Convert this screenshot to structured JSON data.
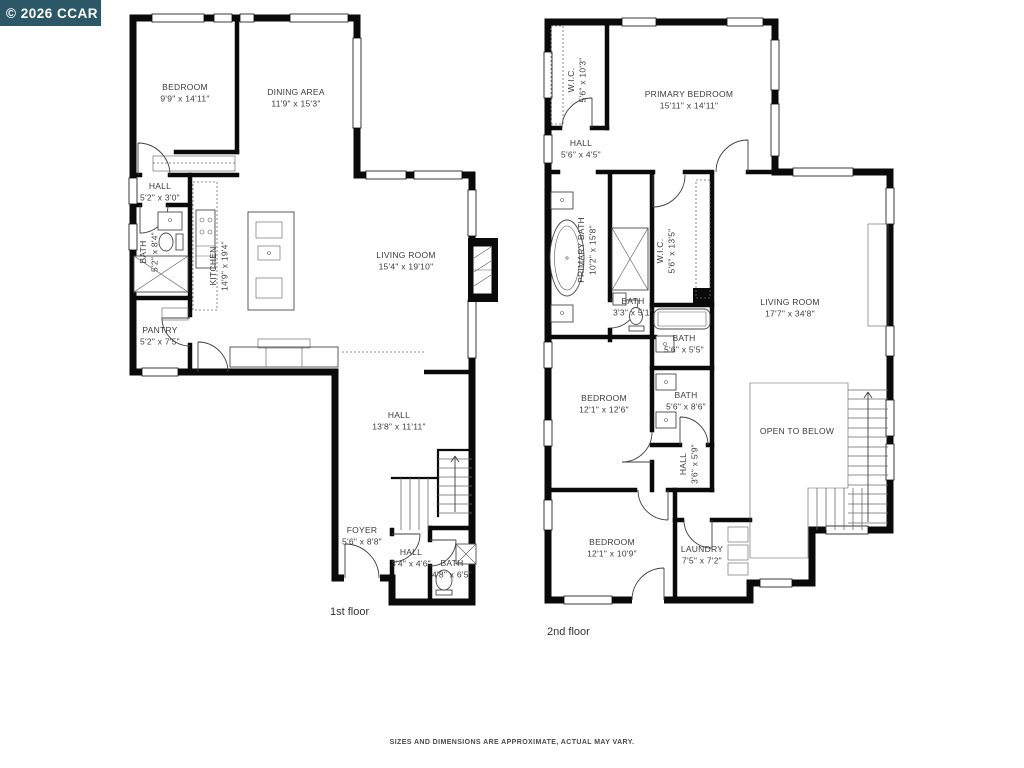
{
  "watermark": {
    "text": "© 2026 CCAR",
    "bg": "#2b5767",
    "fg": "#ffffff"
  },
  "disclaimer": {
    "text": "SIZES AND DIMENSIONS ARE APPROXIMATE, ACTUAL MAY VARY."
  },
  "colors": {
    "wall": "#0a0a0a",
    "label": "#3c3c3c",
    "background": "#ffffff"
  },
  "floors": [
    {
      "id": "floor1",
      "caption": "1st floor",
      "rooms": [
        {
          "name": "BEDROOM",
          "dims": "9'9\" x 14'11\"",
          "x": 185,
          "y": 90,
          "rotate": 0
        },
        {
          "name": "DINING AREA",
          "dims": "11'9\" x 15'3\"",
          "x": 296,
          "y": 95,
          "rotate": 0
        },
        {
          "name": "HALL",
          "dims": "5'2\" x 3'0\"",
          "x": 160,
          "y": 189,
          "rotate": 0
        },
        {
          "name": "BATH",
          "dims": "5'2\" x 8'4\"",
          "x": 146,
          "y": 252,
          "rotate": -90
        },
        {
          "name": "KITCHEN",
          "dims": "14'9\" x 19'4\"",
          "x": 216,
          "y": 266,
          "rotate": -90
        },
        {
          "name": "PANTRY",
          "dims": "5'2\" x 7'5\"",
          "x": 160,
          "y": 333,
          "rotate": 0
        },
        {
          "name": "LIVING ROOM",
          "dims": "15'4\" x 19'10\"",
          "x": 406,
          "y": 258,
          "rotate": 0
        },
        {
          "name": "HALL",
          "dims": "13'8\" x 11'11\"",
          "x": 399,
          "y": 418,
          "rotate": 0
        },
        {
          "name": "FOYER",
          "dims": "5'6\" x 8'8\"",
          "x": 362,
          "y": 533,
          "rotate": 0
        },
        {
          "name": "HALL",
          "dims": "3'4\" x 4'6\"",
          "x": 411,
          "y": 555,
          "rotate": 0
        },
        {
          "name": "BATH",
          "dims": "4'8\" x 6'5\"",
          "x": 452,
          "y": 566,
          "rotate": 0
        }
      ]
    },
    {
      "id": "floor2",
      "caption": "2nd floor",
      "rooms": [
        {
          "name": "W.I.C.",
          "dims": "5'6\" x 10'3\"",
          "x": 574,
          "y": 80,
          "rotate": -90
        },
        {
          "name": "PRIMARY BEDROOM",
          "dims": "15'11\" x 14'11\"",
          "x": 689,
          "y": 97,
          "rotate": 0
        },
        {
          "name": "HALL",
          "dims": "5'6\" x 4'5\"",
          "x": 581,
          "y": 146,
          "rotate": 0
        },
        {
          "name": "PRIMARY BATH",
          "dims": "10'2\" x 15'8\"",
          "x": 584,
          "y": 250,
          "rotate": -90
        },
        {
          "name": "W.I.C.",
          "dims": "5'6\" x 13'5\"",
          "x": 663,
          "y": 251,
          "rotate": -90
        },
        {
          "name": "BATH",
          "dims": "3'3\" x 5'1\"",
          "x": 633,
          "y": 304,
          "rotate": 0
        },
        {
          "name": "BATH",
          "dims": "5'6\" x 5'5\"",
          "x": 684,
          "y": 341,
          "rotate": 0
        },
        {
          "name": "BEDROOM",
          "dims": "12'1\" x 12'6\"",
          "x": 604,
          "y": 401,
          "rotate": 0
        },
        {
          "name": "BATH",
          "dims": "5'6\" x 8'6\"",
          "x": 686,
          "y": 398,
          "rotate": 0
        },
        {
          "name": "HALL",
          "dims": "3'6\" x 5'9\"",
          "x": 686,
          "y": 464,
          "rotate": -90
        },
        {
          "name": "LIVING ROOM",
          "dims": "17'7\" x 34'8\"",
          "x": 790,
          "y": 305,
          "rotate": 0
        },
        {
          "name": "OPEN TO BELOW",
          "dims": "",
          "x": 797,
          "y": 434,
          "rotate": 0
        },
        {
          "name": "BEDROOM",
          "dims": "12'1\" x 10'9\"",
          "x": 612,
          "y": 545,
          "rotate": 0
        },
        {
          "name": "LAUNDRY",
          "dims": "7'5\" x 7'2\"",
          "x": 702,
          "y": 552,
          "rotate": 0
        }
      ]
    }
  ]
}
